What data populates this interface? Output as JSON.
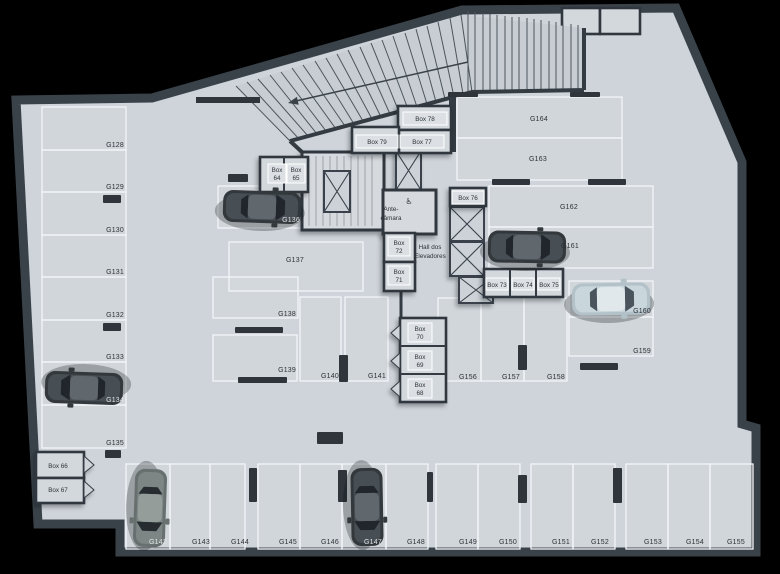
{
  "colors": {
    "background": "#000000",
    "floor": "#ced4da",
    "wall": "#343b42",
    "parking_line": "#f3f6f8",
    "label_text": "#2c3237",
    "car_dark": "#32383c",
    "car_light": "#b3c2c9",
    "car_gray": "#68706f"
  },
  "icons": {
    "accessibility_glyph": "♿"
  },
  "labels": {
    "rooms": {
      "ante": {
        "l1": "Ante-",
        "l2": "câmara"
      },
      "hall": {
        "l1": "Hall dos",
        "l2": "Elevadores"
      }
    },
    "spots": {
      "g128": "G128",
      "g129": "G129",
      "g130": "G130",
      "g131": "G131",
      "g132": "G132",
      "g133": "G133",
      "g134": "G134",
      "g135": "G135",
      "g136": "G136",
      "g137": "G137",
      "g138": "G138",
      "g139": "G139",
      "g140": "G140",
      "g141": "G141",
      "g142": "G142",
      "g143": "G143",
      "g144": "G144",
      "g145": "G145",
      "g146": "G146",
      "g147": "G147",
      "g148": "G148",
      "g149": "G149",
      "g150": "G150",
      "g151": "G151",
      "g152": "G152",
      "g153": "G153",
      "g154": "G154",
      "g155": "G155",
      "g156": "G156",
      "g157": "G157",
      "g158": "G158",
      "g159": "G159",
      "g160": "G160",
      "g161": "G161",
      "g162": "G162",
      "g163": "G163",
      "g164": "G164"
    },
    "boxes": {
      "box64": {
        "l1": "Box",
        "l2": "64"
      },
      "box65": {
        "l1": "Box",
        "l2": "65"
      },
      "box66": "Box 66",
      "box67": "Box 67",
      "box68": {
        "l1": "Box",
        "l2": "68"
      },
      "box69": {
        "l1": "Box",
        "l2": "69"
      },
      "box70": {
        "l1": "Box",
        "l2": "70"
      },
      "box71": {
        "l1": "Box",
        "l2": "71"
      },
      "box72": {
        "l1": "Box",
        "l2": "72"
      },
      "box73": "Box 73",
      "box74": "Box 74",
      "box75": "Box 75",
      "box76": "Box 76",
      "box77": "Box 77",
      "box78": "Box 78",
      "box79": "Box 79"
    }
  }
}
